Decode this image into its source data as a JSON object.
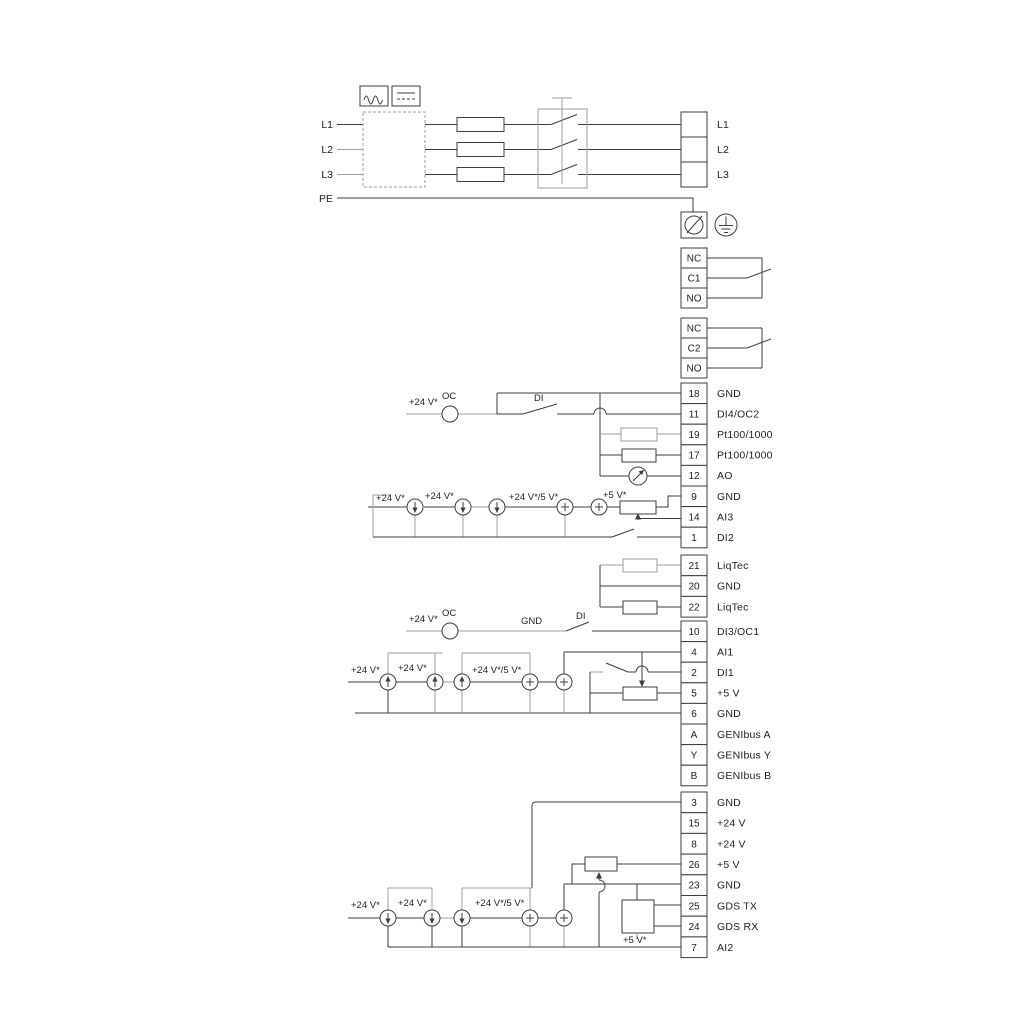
{
  "diagram_title": "drive-power-and-io-wiring-diagram",
  "colors": {
    "line_dark": "#3d3d3d",
    "line_gray": "#9f9f9f",
    "text": "#1f1f1f",
    "background": "#ffffff"
  },
  "mains": {
    "input_labels": [
      "L1",
      "L2",
      "L3",
      "PE"
    ],
    "output_block": {
      "rows": [
        "L1",
        "L2",
        "L3"
      ]
    }
  },
  "relays": [
    {
      "rows": [
        "NC",
        "C1",
        "NO"
      ]
    },
    {
      "rows": [
        "NC",
        "C2",
        "NO"
      ]
    }
  ],
  "terminal_blocks": {
    "block_a": {
      "rows": [
        [
          "18",
          "GND"
        ],
        [
          "11",
          "DI4/OC2"
        ],
        [
          "19",
          "Pt100/1000"
        ],
        [
          "17",
          "Pt100/1000"
        ],
        [
          "12",
          "AO"
        ],
        [
          "9",
          "GND"
        ],
        [
          "14",
          "AI3"
        ],
        [
          "1",
          "DI2"
        ]
      ]
    },
    "liqtec": {
      "rows": [
        [
          "21",
          "LiqTec"
        ],
        [
          "20",
          "GND"
        ],
        [
          "22",
          "LiqTec"
        ]
      ]
    },
    "block_b": {
      "rows": [
        [
          "10",
          "DI3/OC1"
        ],
        [
          "4",
          "AI1"
        ],
        [
          "2",
          "DI1"
        ],
        [
          "5",
          "+5 V"
        ],
        [
          "6",
          "GND"
        ],
        [
          "A",
          "GENIbus A"
        ],
        [
          "Y",
          "GENIbus Y"
        ],
        [
          "B",
          "GENIbus B"
        ]
      ]
    },
    "block_c": {
      "rows": [
        [
          "3",
          "GND"
        ],
        [
          "15",
          "+24 V"
        ],
        [
          "8",
          "+24 V"
        ],
        [
          "26",
          "+5 V"
        ],
        [
          "23",
          "GND"
        ],
        [
          "25",
          "GDS TX"
        ],
        [
          "24",
          "GDS RX"
        ],
        [
          "7",
          "AI2"
        ]
      ]
    }
  },
  "wire_labels": {
    "v24": "+24 V*",
    "v24_5": "+24 V*/5 V*",
    "v5": "+5 V*",
    "oc": "OC",
    "di": "DI",
    "gnd": "GND"
  }
}
